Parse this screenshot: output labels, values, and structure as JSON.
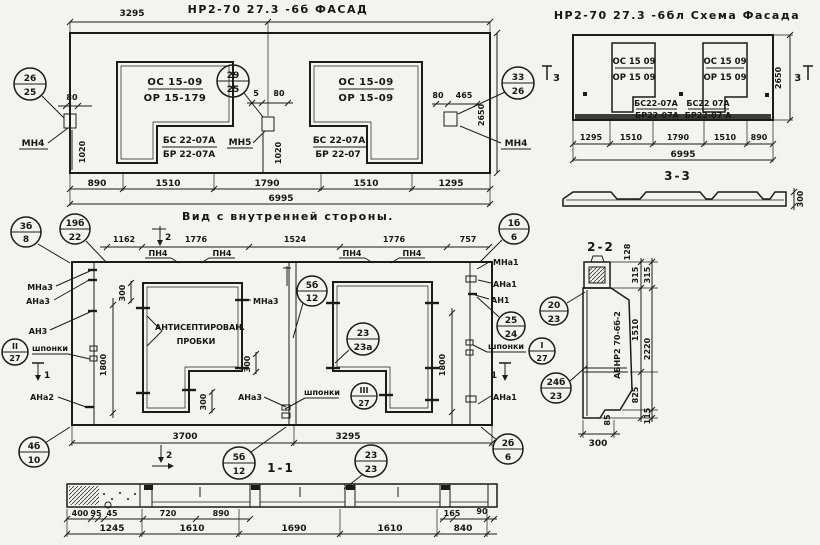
{
  "colors": {
    "paper": "#f4f3ee",
    "ink": "#1b1b1b"
  },
  "facade": {
    "title": "НР2-70 27.3 -6б  ФАСАД",
    "dim_top": "3295",
    "win1_top1": "ОС 15-09",
    "win1_top2": "ОР 15-179",
    "win1_bot1": "БС 22-07А",
    "win1_bot2": "БР 22-07А",
    "win2_top1": "ОС 15-09",
    "win2_top2": "ОР 15-09",
    "win2_bot1": "БС 22-07А",
    "win2_bot2": "БР 22-07",
    "co_left_t": "26",
    "co_left_b": "25",
    "co_mid_t": "29",
    "co_mid_b": "25",
    "co_right_t": "33",
    "co_right_b": "26",
    "mn_left": "МН4",
    "mn_mid": "МН5",
    "mn_right": "МН4",
    "d80l": "80",
    "d1020l": "1020",
    "d5": "5",
    "d80m": "80",
    "d1020m": "1020",
    "d80r": "80",
    "d465": "465",
    "d2650": "2650",
    "db0": "890",
    "db1": "1510",
    "db2": "1790",
    "db3": "1510",
    "db4": "1295",
    "dtotal": "6995"
  },
  "schema": {
    "title": "НР2-70 27.3 -6бл Схема Фасада",
    "winA_top1": "ОС 15 09",
    "winA_top2": "ОР 15 09",
    "winA_bot1": "БС22-07А",
    "winA_bot2": "БР22-07А",
    "winB_top1": "ОС 15 09",
    "winB_top2": "ОР 15 09",
    "winB_bot1": "БС22 07А",
    "winB_bot2": "БР22-07 А",
    "mark3": "3",
    "d2650": "2650",
    "db0": "1295",
    "db1": "1510",
    "db2": "1790",
    "db3": "1510",
    "db4": "890",
    "dtotal": "6995",
    "sec33": "3-3",
    "d300": "300"
  },
  "inner": {
    "title": "Вид с внутренней стороны.",
    "co_3b_t": "3б",
    "co_3b_b": "8",
    "co_19b_t": "19б",
    "co_19b_b": "22",
    "dt0": "1162",
    "dt1": "1776",
    "dt2": "1524",
    "dt3": "1776",
    "dt4": "757",
    "pn4": "ПН4",
    "mark2": "2",
    "mark1": "1",
    "mna3": "МНа3",
    "ana3": "АНа3",
    "an3": "АН3",
    "ana2": "АНа2",
    "shponki": "шпонки",
    "co_II_t": "II",
    "co_II_b": "27",
    "co_III_t": "III",
    "co_III_b": "27",
    "co_I_t": "I",
    "co_I_b": "27",
    "antisep1": "АНТИСЕПТИРОВАН.",
    "antisep2": "ПРОБКИ",
    "mna3_in": "МНа3",
    "ana3_in": "АНа3",
    "co_5b_t": "5б",
    "co_5b_b": "12",
    "co_23a_t": "23",
    "co_23a_b": "23а",
    "d300": "300",
    "d1800": "1800",
    "mna1": "МНа1",
    "ana1": "АНа1",
    "an1": "АН1",
    "ana1b": "АНа1",
    "co_25_t": "25",
    "co_25_b": "24",
    "co_1b_t": "1б",
    "co_1b_b": "6",
    "db0": "3700",
    "db1": "3295",
    "co_4b_t": "4б",
    "co_4b_b": "10",
    "co_2b_t": "2б",
    "co_2b_b": "6"
  },
  "sec11": {
    "label": "1-1",
    "co_5b_t": "5б",
    "co_5b_b": "12",
    "co_23_t": "23",
    "co_23_b": "23",
    "r1": [
      "400",
      "95",
      "45",
      "720",
      "890",
      "165",
      "90"
    ],
    "r2": [
      "1245",
      "1610",
      "1690",
      "1610",
      "840"
    ]
  },
  "sec22": {
    "label": "2-2",
    "stamp": "АБНР2 70-6б-2",
    "co_20_t": "20",
    "co_20_b": "23",
    "co_24b_t": "24б",
    "co_24b_b": "23",
    "d128": "128",
    "d315a": "315",
    "d315b": "315",
    "d1510": "1510",
    "d2220": "2220",
    "d825": "825",
    "d85": "85",
    "d115": "115",
    "d300": "300"
  }
}
